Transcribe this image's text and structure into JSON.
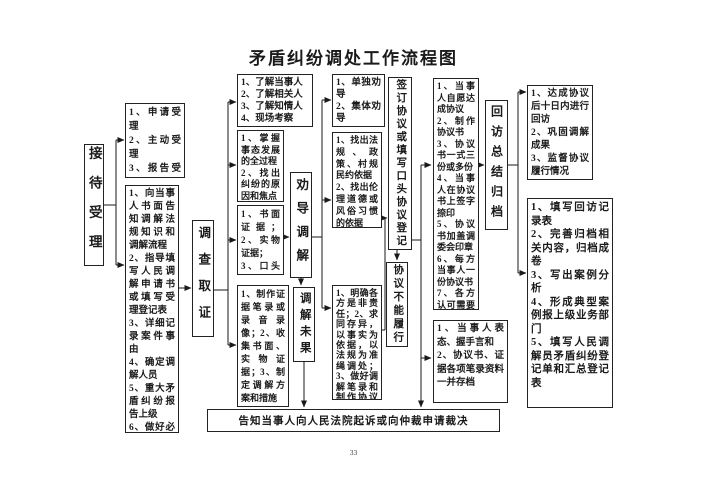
{
  "title": "矛盾纠纷调处工作流程图",
  "page_number": "33",
  "stages": {
    "reception": "接待受理",
    "investigation": "调查取证",
    "persuasion": "劝导调解",
    "mediation_failed": "调解未果",
    "agreement": "签订协议或填写口头协议登记",
    "agreement_unenforceable": "协议不能履行",
    "review": "回访总结归档"
  },
  "boxes": {
    "reception_methods": "1、申请受理\n2、主动受理\n3、报告受理\n4、委托受理\n5、指定受理",
    "reception_tasks": "1、向当事人书面告知调解法规知识和调解流程\n2、指导填写人民调解申请书或填写受理登记表\n3、详细记录案件事由\n4、确定调解人员\n5、重大矛盾纠纷报告上级\n6、做好必要的准备工作",
    "investigation_targets": "1、了解当事人\n2、了解相关人\n3、了解知情人\n4、现场考察",
    "investigation_goals": "1、掌握事态发展的全过程\n2、找出纠纷的原因和焦点",
    "evidence_types": "1、书面证据；2、实物证据；\n3、口头及其他证据",
    "evidence_tasks": "1、制作证据笔录或录音录像；2、收集书面、实物证据；3、制定调解方案和措施",
    "persuasion_methods": "1、单独劝导\n2、集体劝导",
    "persuasion_basis": "1、找出法规、政策、村规民约依据\n2、找出伦理道德或风俗习惯的依据",
    "mediation_principles": "1、明确各方是非责任；2、求同存异，以事实为依据，以法规为准绳调处；3、做好调解笔录和制作协议书的准备工作",
    "agreement_tasks": "1、当事人自愿达成协议\n2、制作协议书\n3、协议书一式三份或多份\n4、当事人在协议书上签字捺印\n5、协议书加盖调委会印章\n6、每方当事人一份协议书\n7、各方认可需要办理司法确认",
    "oral_agreement_tasks": "1、当事人表态、握手言和\n2、协议书、证据各项笔录资料一并存档",
    "review_visit": "1、达成协议后十日内进行回访\n2、巩固调解成果\n3、监督协议履行情况",
    "archive_tasks": "1、填写回访记录表\n2、完善归档相关内容，归档成卷\n3、写出案例分析\n4、形成典型案例报上级业务部门\n5、填写人民调解员矛盾纠纷登记单和汇总登记表",
    "lawsuit_notice": "告知当事人向人民法院起诉或向仲裁申请裁决"
  }
}
